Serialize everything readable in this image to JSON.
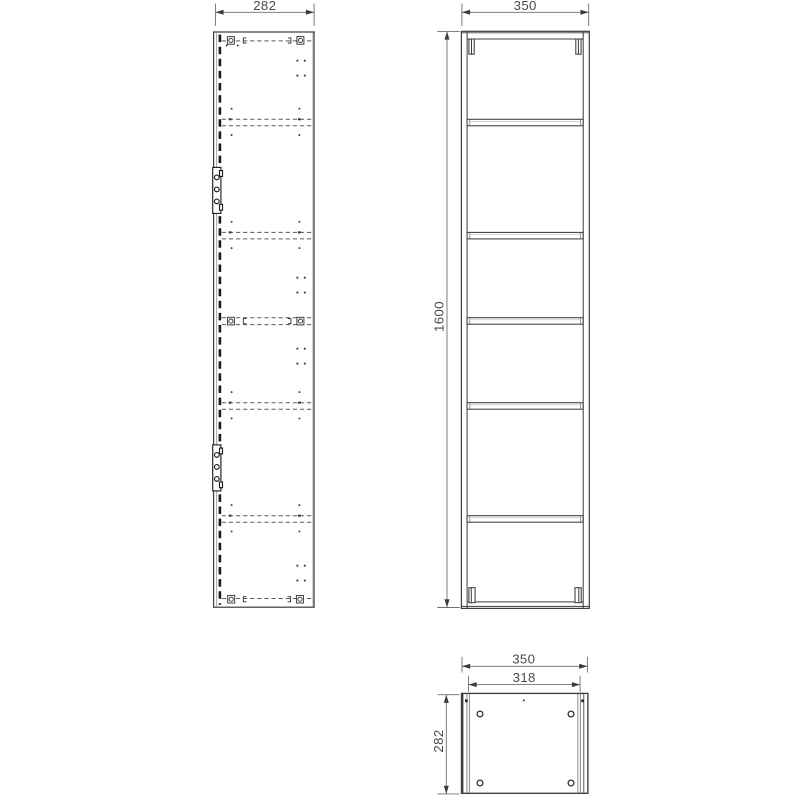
{
  "drawing": {
    "views": {
      "side": {
        "dims": {
          "width": "282"
        }
      },
      "front": {
        "dims": {
          "width": "350",
          "height": "1600"
        }
      },
      "bottom": {
        "dims": {
          "outer_width": "350",
          "inner_width": "318",
          "depth": "282"
        }
      }
    },
    "colors": {
      "background": "#ffffff",
      "line": "#3c3c3c",
      "hidden_line": "#5a5a5a",
      "door_hidden_line": "#1a1a1a",
      "dimension_line": "#6f6f6f",
      "dimension_text": "#4a4a4a"
    }
  }
}
